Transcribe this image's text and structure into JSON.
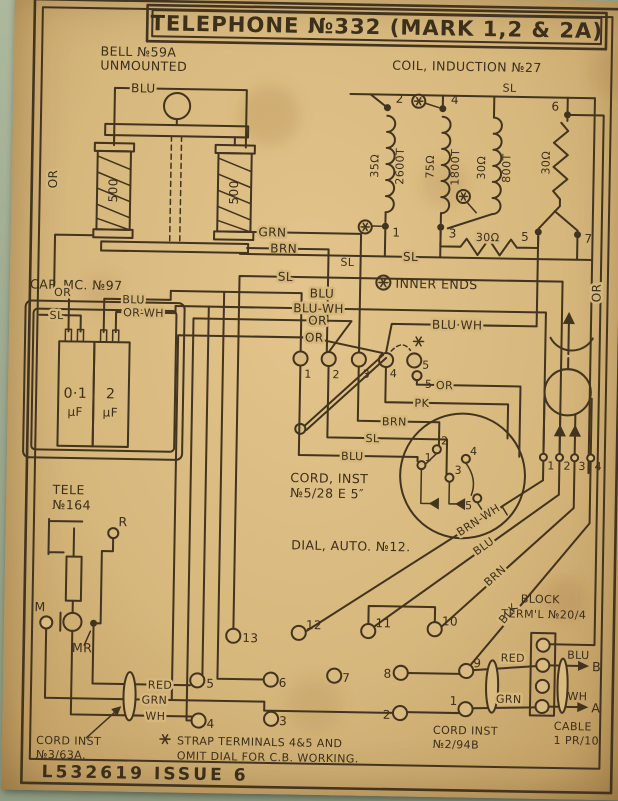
{
  "colors": {
    "paper": "#d6b77c",
    "ink": "#43341f",
    "background": "#9aa78d"
  },
  "title": "TELEPHONE №332 (MARK 1,2 & 2A)",
  "footer": "L532619  ISSUE  6",
  "bell": {
    "line1": "BELL №59A",
    "line2": "UNMOUNTED",
    "coil_left": "500",
    "coil_right": "500",
    "wire_blu": "BLU",
    "wire_or": "OR",
    "wire_grn": "GRN",
    "wire_brn": "BRN"
  },
  "coil": {
    "title": "COIL, INDUCTION №27",
    "sl_top": "SL",
    "sl_bottom": "SL",
    "t1": "1",
    "t2": "2",
    "t3": "3",
    "t4": "4",
    "t5": "5",
    "t6": "6",
    "t7": "7",
    "w1_ohms": "35Ω",
    "w1_turns": "2600T",
    "w2_ohms": "75Ω",
    "w2_turns": "1800T",
    "w3_ohms": "30Ω",
    "w3_turns": "800T",
    "r_vert": "30Ω",
    "r_horiz": "30Ω"
  },
  "legend": {
    "inner_ends": "INNER ENDS"
  },
  "cap": {
    "title": "CAP. MC. №97",
    "val1": "0·1",
    "unit1": "μF",
    "val2": "2",
    "unit2": "μF",
    "wire_or": "OR",
    "wire_sl": "SL",
    "wire_blu": "BLU",
    "wire_orwh": "OR-WH"
  },
  "bus": {
    "sl_long": "SL",
    "sl": "SL",
    "blu": "BLU",
    "blu_wh": "BLU-WH",
    "or1": "OR",
    "or2": "OR",
    "blu_wh2": "BLU·WH",
    "or_right": "OR"
  },
  "hook": {
    "t1": "1",
    "t2": "2",
    "t3": "3",
    "t4": "4",
    "t5": "5",
    "t5b": "5"
  },
  "cord5": {
    "line1": "CORD, INST",
    "line2": "№5/28 E 5″",
    "wire_or": "OR",
    "wire_pk": "PK",
    "wire_brn": "BRN",
    "wire_sl": "SL",
    "wire_blu": "BLU"
  },
  "dial": {
    "label": "DIAL, AUTO. №12.",
    "t1": "1",
    "t2": "2",
    "t3": "3",
    "t4": "4",
    "t5": "5"
  },
  "handset": {
    "t1": "1",
    "t2": "2",
    "t3": "3",
    "t4": "4"
  },
  "cords": {
    "brnwh": "BRN-WH",
    "blu": "BLU",
    "brn": "BRN",
    "blk": "BLK"
  },
  "tele": {
    "line1": "TELE",
    "line2": "№164",
    "r": "R",
    "m": "M",
    "mr": "MR"
  },
  "strip": {
    "t13": "13",
    "t12": "12",
    "t11": "11",
    "t10": "10",
    "t5": "5",
    "t6": "6",
    "t7": "7",
    "t8": "8",
    "t9": "9",
    "t4": "4",
    "t3": "3",
    "t2": "2",
    "t1": "1"
  },
  "cord3": {
    "wire_red": "RED",
    "wire_grn": "GRN",
    "wire_wh": "WH",
    "line1": "CORD INST",
    "line2": "№3/63A."
  },
  "note": {
    "line1": "STRAP TERMINALS 4&5 AND",
    "line2": "OMIT DIAL FOR C.B. WORKING."
  },
  "block": {
    "line1": "BLOCK",
    "line2": "TERM'L №20/4",
    "wire_red": "RED",
    "wire_grn": "GRN",
    "wire_blu": "BLU",
    "wire_wh": "WH",
    "a": "A",
    "b": "B"
  },
  "cord2": {
    "line1": "CORD INST",
    "line2": "№2/94B"
  },
  "cable": {
    "line1": "CABLE",
    "line2": "1 PR/10"
  }
}
